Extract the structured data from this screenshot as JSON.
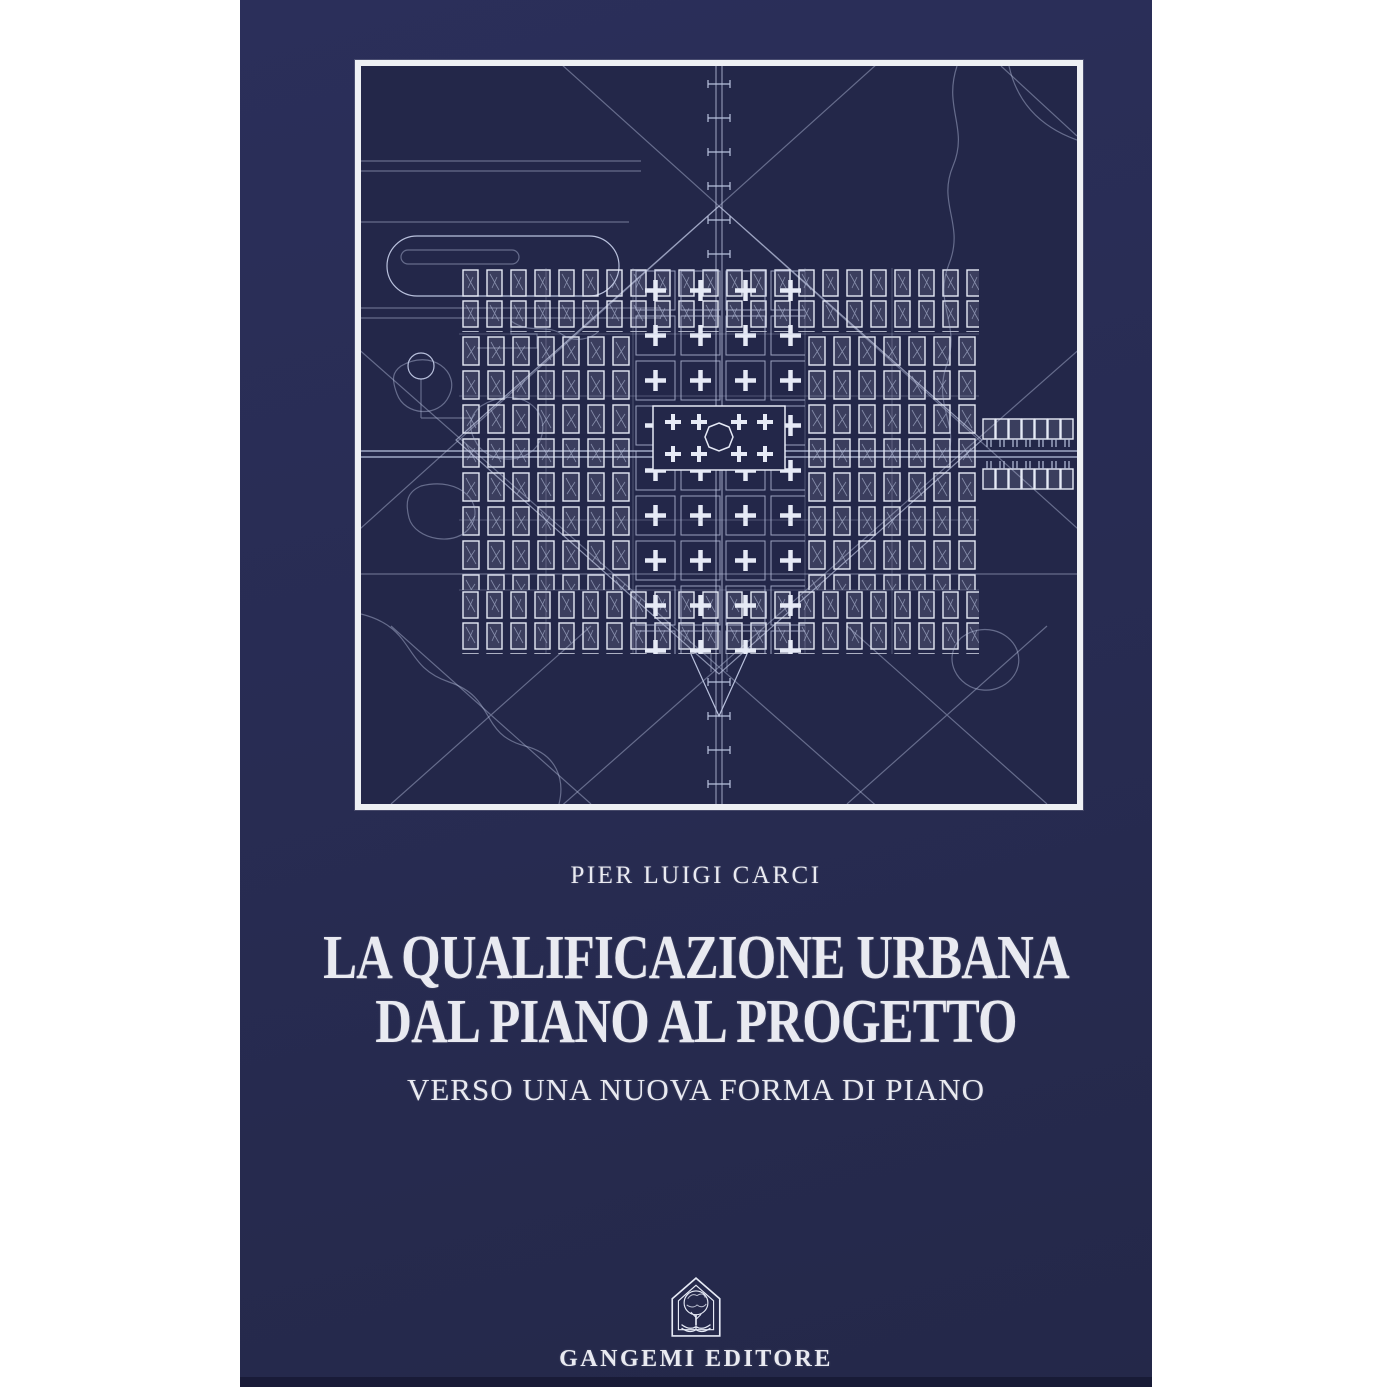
{
  "cover": {
    "author": "PIER LUIGI CARCI",
    "title_line1": "LA QUALIFICAZIONE URBANA",
    "title_line2": "DAL PIANO AL PROGETTO",
    "subtitle": "VERSO UNA NUOVA FORMA DI PIANO",
    "publisher": "GANGEMI EDITORE",
    "artwork": "blueprint-city-plan",
    "logo_icon": "gangemi-house-tree-book-logo"
  },
  "colors": {
    "page_bg": "#ffffff",
    "cover_navy": "#282c53",
    "map_navy": "#232749",
    "line_soft": "#b9c1dd",
    "line_bright": "#e6eaf6",
    "frame_white": "#eef0f4",
    "text_white": "#e9eaf1"
  }
}
